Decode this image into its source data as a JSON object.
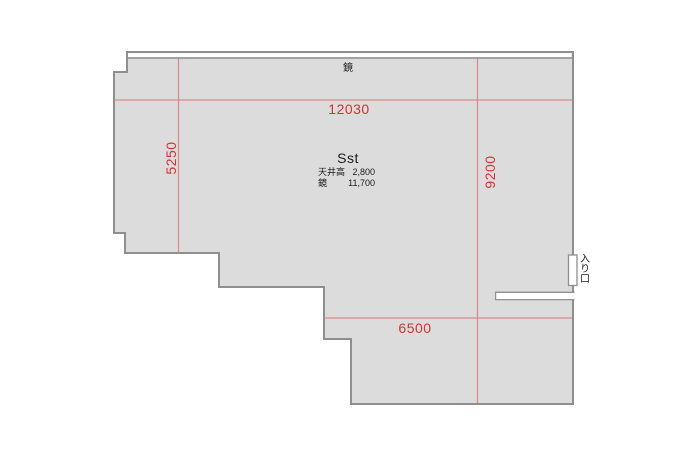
{
  "floorplan": {
    "top_wall_label": "鏡",
    "room": {
      "name": "Sst",
      "info_rows": [
        {
          "label": "天井高",
          "value": "2,800"
        },
        {
          "label": "鏡",
          "value": "11,700"
        }
      ]
    },
    "dimensions": {
      "top_width": "12030",
      "left_height": "5250",
      "right_height": "9200",
      "bottom_width": "6500"
    },
    "entrance_label": "入り口",
    "colors": {
      "background": "#ffffff",
      "room_fill": "#dcdcdc",
      "wall_outline": "#8f8f8f",
      "dimension_line": "#d98b8b",
      "dimension_text": "#d23333",
      "label_text": "#1a1a1a"
    }
  }
}
